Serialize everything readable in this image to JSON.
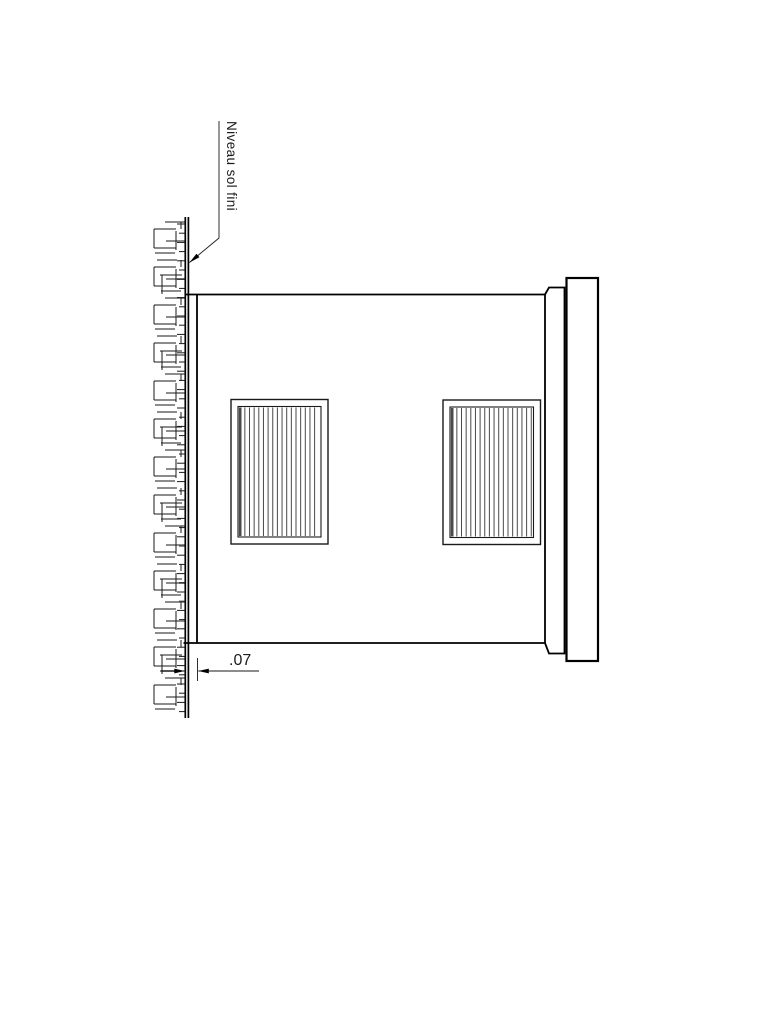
{
  "drawing": {
    "labels": {
      "ground_level": "Niveau sol fini",
      "dimension": ".07"
    },
    "label_pos": {
      "ground_level": {
        "left": 240,
        "top": 121,
        "font": 13.5
      },
      "dimension": {
        "left": 229,
        "top": 653,
        "font": 16
      }
    },
    "colors": {
      "line": "#1a1a1a",
      "bold": "#000000",
      "gray": "#8c8c8c",
      "stripe": "#4a4a4a",
      "background": "#ffffff"
    },
    "geometry": {
      "canvas": {
        "w": 768,
        "h": 1024
      },
      "wall": {
        "x1": 185.3,
        "x2": 188.4,
        "top": 217,
        "bottom": 718,
        "stroke": 1.7
      },
      "hatch": {
        "top": 222,
        "bottom": 713,
        "unit": 38,
        "tick_x1": 177,
        "tick_x1_alt": 179,
        "tick_x2": 185.2,
        "tick_start": 224,
        "tick_step": 9.2
      },
      "body": {
        "left": 197,
        "top": 294.5,
        "right": 545,
        "bottom": 643,
        "top_edge_x0": 186,
        "bottom_edge_x0": 183.5,
        "stroke": 1.8
      },
      "step": {
        "x1": 545,
        "x2": 564.5,
        "top": 287.5,
        "bottom": 653.5,
        "chamfer_x": 549,
        "stroke": 1.8
      },
      "outer": {
        "left": 566.5,
        "right": 598,
        "top": 278,
        "bottom": 661,
        "stroke": 2.2
      },
      "grilles": [
        {
          "x": 231,
          "y": 399.5,
          "w": 97,
          "h": 144.5
        },
        {
          "x": 443,
          "y": 400,
          "w": 97.5,
          "h": 144.5
        }
      ],
      "grille_style": {
        "inset": 7,
        "stripe_step": 4.65,
        "stripe_stroke": 1,
        "outer_stroke": 1.4,
        "inner_stroke": 1.1,
        "first_stripe_stroke": 2.6
      },
      "leader": {
        "pts": [
          [
            219,
            121
          ],
          [
            219,
            238
          ],
          [
            189.5,
            262.5
          ]
        ],
        "arrow_len": 11,
        "arrow_halfw": 2.3,
        "stroke": 0.9
      },
      "dim": {
        "y": 671,
        "ext_x": 197.5,
        "ext_y1": 658,
        "ext_y2": 681,
        "left_tail_x": 160,
        "left_tip_x": 184.8,
        "right_tip_x": 198.3,
        "right_tail_x": 259,
        "arrow_len": 10.5,
        "arrow_halfw": 2.4,
        "stroke": 0.9
      }
    }
  }
}
